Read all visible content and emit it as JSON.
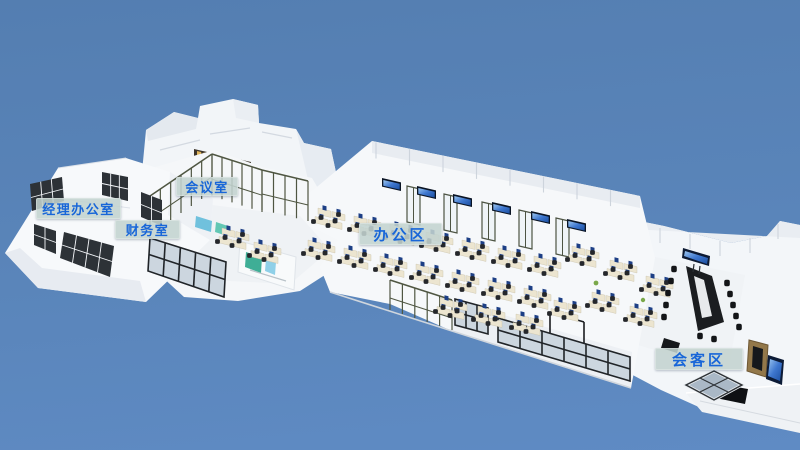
{
  "scene": {
    "type": "3d-office-building-overview",
    "colors": {
      "sky_top": "#547EB1",
      "sky_bottom": "#5F8BC4",
      "building_white": "#F5F7FA",
      "label_bg": "#C3D3CF",
      "label_text": "#1866D8",
      "window_frame": "#2D3237",
      "glass_frame_olive": "#4F5642",
      "screen_blue": "#2E6AC8",
      "desk_tan": "#ECE5D0",
      "conference_table": "#1B1D20"
    }
  },
  "labels": [
    {
      "id": "manager-office",
      "text": "经理办公室"
    },
    {
      "id": "finance-room",
      "text": "财务室"
    },
    {
      "id": "meeting-room",
      "text": "会议室"
    },
    {
      "id": "office-area",
      "text": "办公区"
    },
    {
      "id": "reception-area",
      "text": "会客区"
    }
  ]
}
